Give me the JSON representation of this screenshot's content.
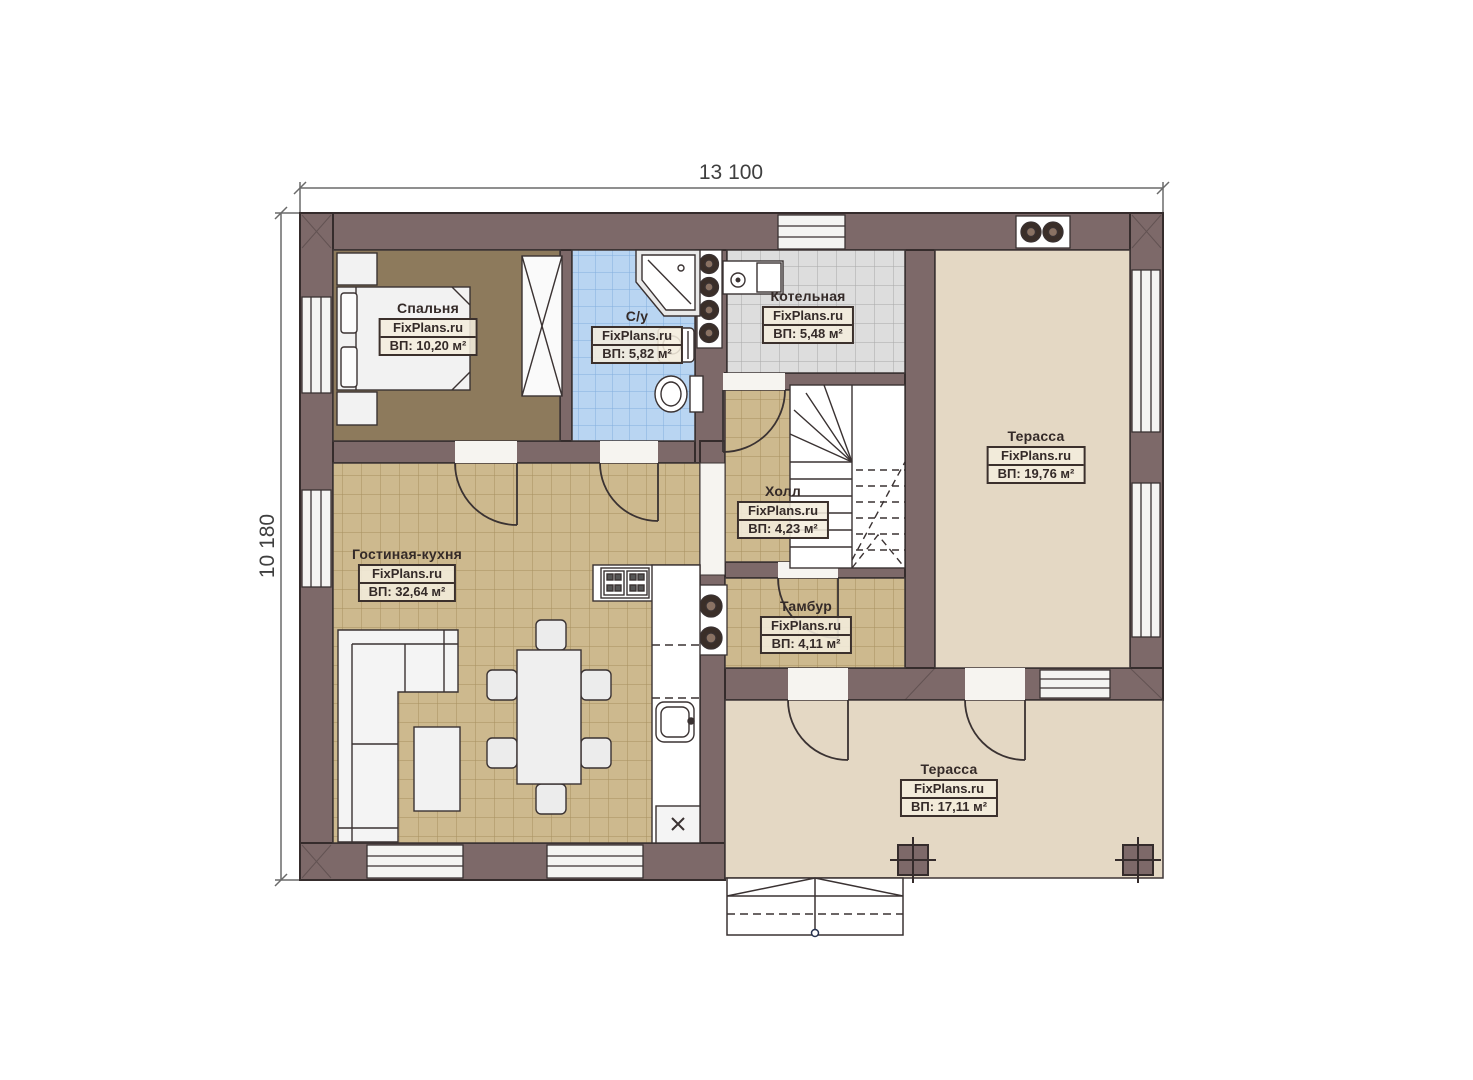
{
  "page": {
    "background": "#ffffff"
  },
  "dimensions": {
    "width_label": "13 100",
    "height_label": "10 180"
  },
  "watermark": "FixPlans.ru",
  "rooms": [
    {
      "id": "bedroom",
      "name": "Спальня",
      "site": "FixPlans.ru",
      "area": "ВП: 10,20 м²"
    },
    {
      "id": "bathroom",
      "name": "С/у",
      "site": "FixPlans.ru",
      "area": "ВП: 5,82 м²"
    },
    {
      "id": "boiler",
      "name": "Котельная",
      "site": "FixPlans.ru",
      "area": "ВП: 5,48 м²"
    },
    {
      "id": "terrace-upper",
      "name": "Терасса",
      "site": "FixPlans.ru",
      "area": "ВП: 19,76 м²"
    },
    {
      "id": "hall",
      "name": "Холл",
      "site": "FixPlans.ru",
      "area": "ВП: 4,23 м²"
    },
    {
      "id": "living-kitchen",
      "name": "Гостиная-кухня",
      "site": "FixPlans.ru",
      "area": "ВП: 32,64 м²"
    },
    {
      "id": "vestibule",
      "name": "Тамбур",
      "site": "FixPlans.ru",
      "area": "ВП: 4,11 м²"
    },
    {
      "id": "terrace-lower",
      "name": "Терасса",
      "site": "FixPlans.ru",
      "area": "ВП: 17,11 м²"
    }
  ],
  "colors": {
    "wall": "#7d6969",
    "line": "#3a3232",
    "floor_tan": "#cdb98e",
    "floor_blue": "#b9d5f2",
    "floor_gray": "#dddddd",
    "floor_bedroom": "#8d7a5c",
    "terrace": "#e4d8c4"
  }
}
